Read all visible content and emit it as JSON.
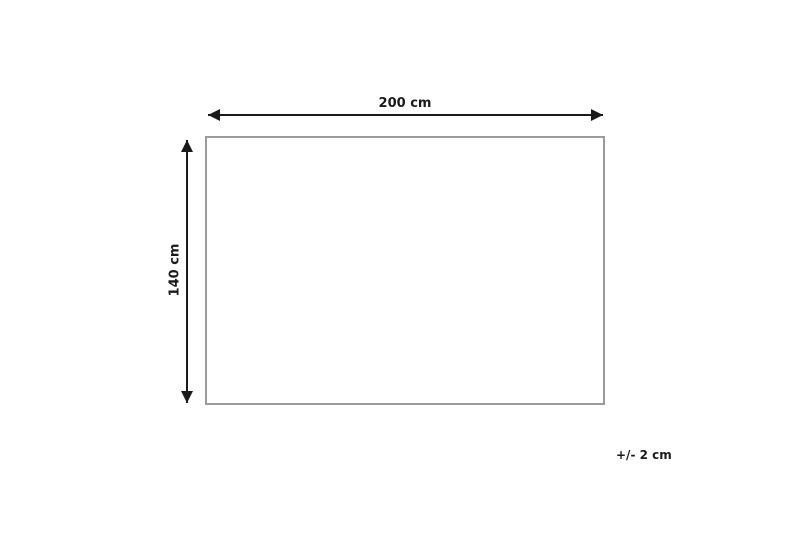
{
  "diagram": {
    "type": "product-dimension-diagram",
    "width_label": "200 cm",
    "height_label": "140 cm",
    "tolerance_label": "+/- 2 cm"
  },
  "colors": {
    "background": "#ffffff",
    "arrow": "#1a1a1a",
    "outline_border": "#9b9b9b",
    "label_text": "#1a1a1a"
  }
}
